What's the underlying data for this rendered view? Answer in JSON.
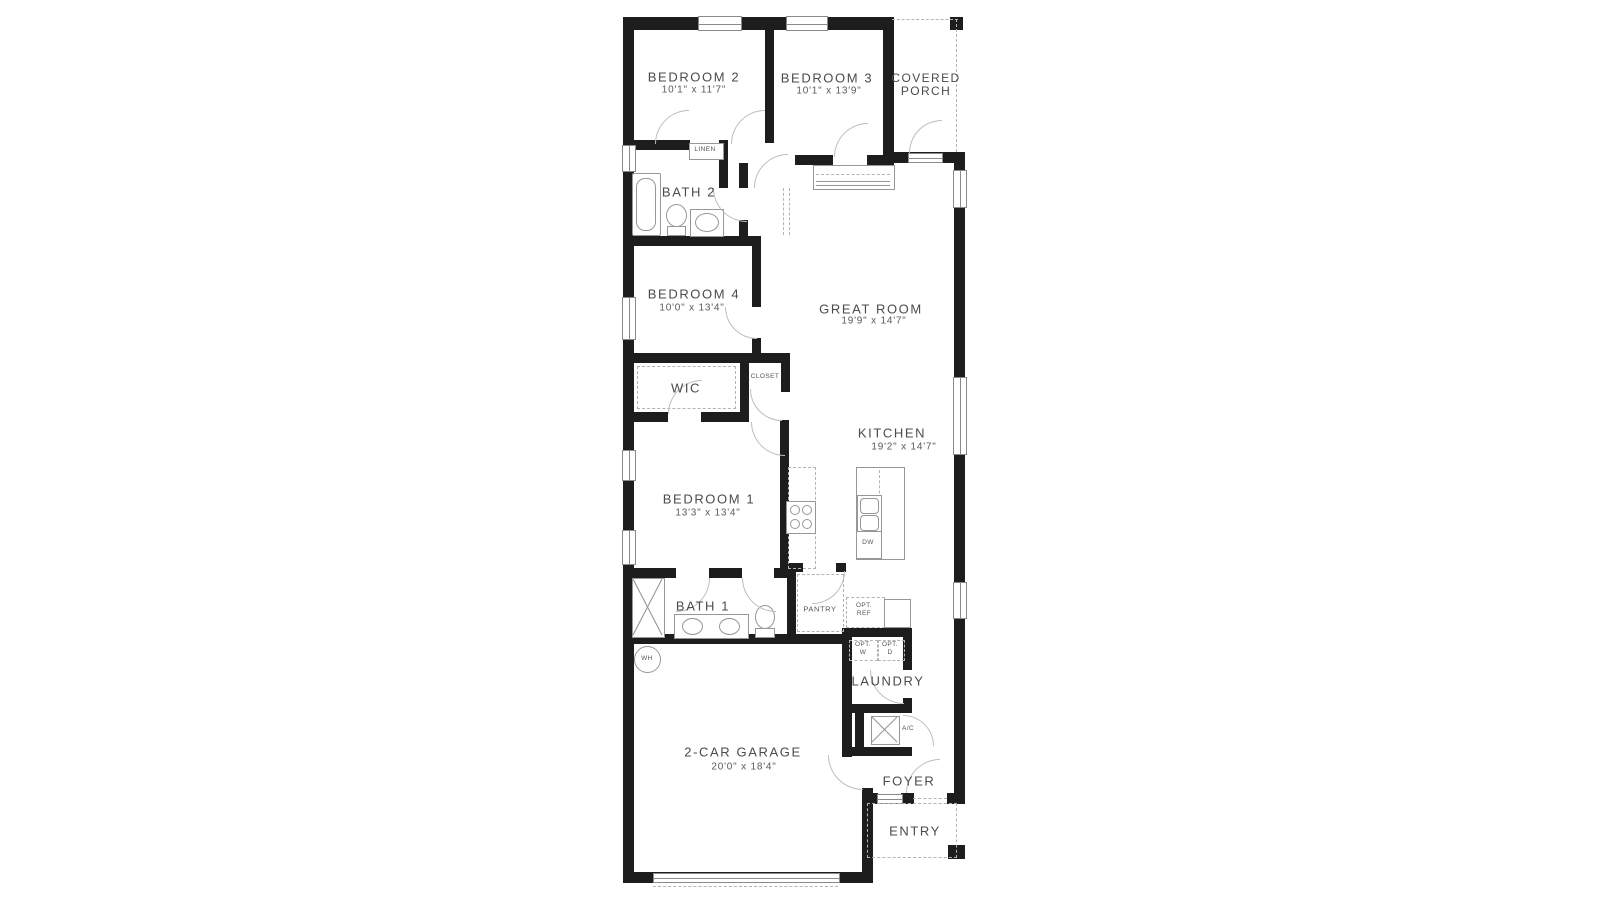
{
  "rooms": {
    "bedroom2": {
      "name": "BEDROOM 2",
      "dims": "10'1\" x 11'7\""
    },
    "bedroom3": {
      "name": "BEDROOM 3",
      "dims": "10'1\" x 13'9\""
    },
    "covered_porch": {
      "line1": "COVERED",
      "line2": "PORCH"
    },
    "bath2": {
      "name": "BATH 2"
    },
    "bedroom4": {
      "name": "BEDROOM 4",
      "dims": "10'0\" x 13'4\""
    },
    "great_room": {
      "name": "GREAT ROOM",
      "dims": "19'9\" x 14'7\""
    },
    "wic": {
      "name": "WIC"
    },
    "kitchen": {
      "name": "KITCHEN",
      "dims": "19'2\" x 14'7\""
    },
    "bedroom1": {
      "name": "BEDROOM 1",
      "dims": "13'3\" x 13'4\""
    },
    "bath1": {
      "name": "BATH 1"
    },
    "pantry": {
      "name": "PANTRY"
    },
    "laundry": {
      "name": "LAUNDRY"
    },
    "garage": {
      "name": "2-CAR GARAGE",
      "dims": "20'0\" x 18'4\""
    },
    "foyer": {
      "name": "FOYER"
    },
    "entry": {
      "name": "ENTRY"
    }
  },
  "labels": {
    "linen": "LINEN",
    "closet": "CLOSET",
    "wh": "WH",
    "ac": "A/C",
    "dw": "DW",
    "opt_ref": {
      "line1": "OPT.",
      "line2": "REF"
    },
    "opt_w": {
      "line1": "OPT.",
      "line2": "W"
    },
    "opt_d": {
      "line1": "OPT.",
      "line2": "D"
    }
  },
  "colors": {
    "wall": "#1d1d1d",
    "fixture_line": "#979797",
    "dash_line": "#b3b3b3",
    "label_text": "#4b4b4b",
    "background": "#ffffff"
  }
}
